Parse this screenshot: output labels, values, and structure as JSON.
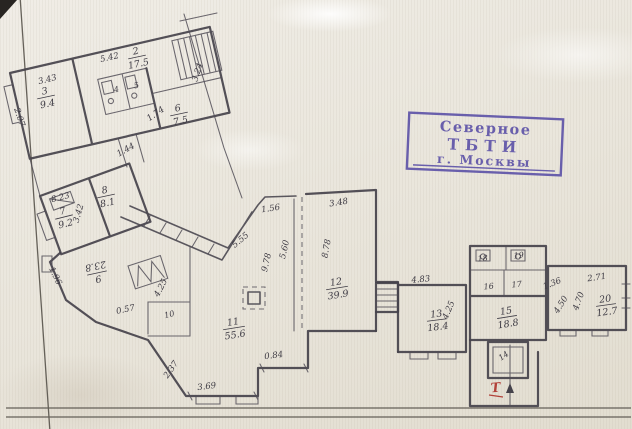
{
  "stamp": {
    "line1": "Северное",
    "line2": "ТБТИ",
    "line3": "г. Москвы",
    "color": "#584da6"
  },
  "plan": {
    "entrance_mark": "Т",
    "rooms": {
      "r2": {
        "num": "2",
        "area": "17.5"
      },
      "r3": {
        "num": "3",
        "area": "9.4"
      },
      "r6": {
        "num": "6",
        "area": "7.5"
      },
      "r7": {
        "num": "7",
        "area": "9.2"
      },
      "r8": {
        "num": "8",
        "area": "8.1"
      },
      "r9": {
        "num": "9",
        "area": "23.8"
      },
      "r11": {
        "num": "11",
        "area": "55.6"
      },
      "r12": {
        "num": "12",
        "area": "39.9"
      },
      "r13": {
        "num": "13",
        "area": "18.4"
      },
      "r15": {
        "num": "15",
        "area": "18.8"
      },
      "r20": {
        "num": "20",
        "area": "12.7"
      }
    },
    "cells": {
      "r4": "4",
      "r5": "5",
      "r10": "10",
      "r14": "14",
      "r16": "16",
      "r17": "17",
      "r18": "18",
      "r19": "19"
    },
    "dims": {
      "d343": "3.43",
      "d542": "5.42",
      "d207": "2.07",
      "d324": "3.24",
      "d174": "1.74",
      "d144": "1.44",
      "d823": "8.23",
      "d342": "3.42",
      "d196": "1.96",
      "d425a": "4.25",
      "d057": "0.57",
      "d237": "2.37",
      "d369": "3.69",
      "d555": "5.55",
      "d156": "1.56",
      "d978": "9.78",
      "d560": "5.60",
      "d084": "0.84",
      "d348": "3.48",
      "d878": "8.78",
      "d483": "4.83",
      "d425b": "4.25",
      "d136": "1.36",
      "d271": "2.71",
      "d450": "4.50",
      "d470": "4.70"
    }
  }
}
